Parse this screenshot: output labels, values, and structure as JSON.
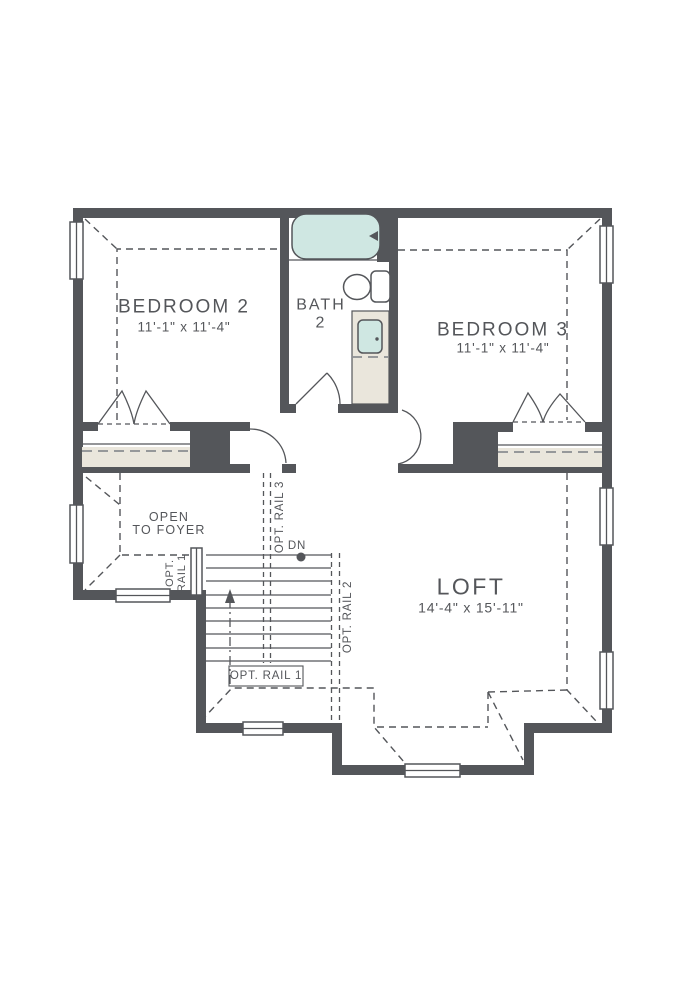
{
  "title": "Second floor plan",
  "colors": {
    "wall": "#54565A",
    "fixture_teal": "#CFE7E2",
    "cabinet_beige": "#EAE6DC",
    "background": "#FFFFFF"
  },
  "rooms": {
    "bedroom2": {
      "name": "BEDROOM 2",
      "dims": "11'-1\" x 11'-4\""
    },
    "bedroom3": {
      "name": "BEDROOM 3",
      "dims": "11'-1\" x 11'-4\""
    },
    "bath2": {
      "name": "BATH",
      "number": "2"
    },
    "loft": {
      "name": "LOFT",
      "dims": "14'-4\" x 15'-11\""
    },
    "foyer": {
      "label": "OPEN\nTO FOYER"
    }
  },
  "labels": {
    "down": "DN",
    "rail1": "OPT. RAIL 1",
    "rail1_stacked": "OPT.\nRAIL 1",
    "rail2": "OPT. RAIL 2",
    "rail3": "OPT. RAIL 3"
  }
}
